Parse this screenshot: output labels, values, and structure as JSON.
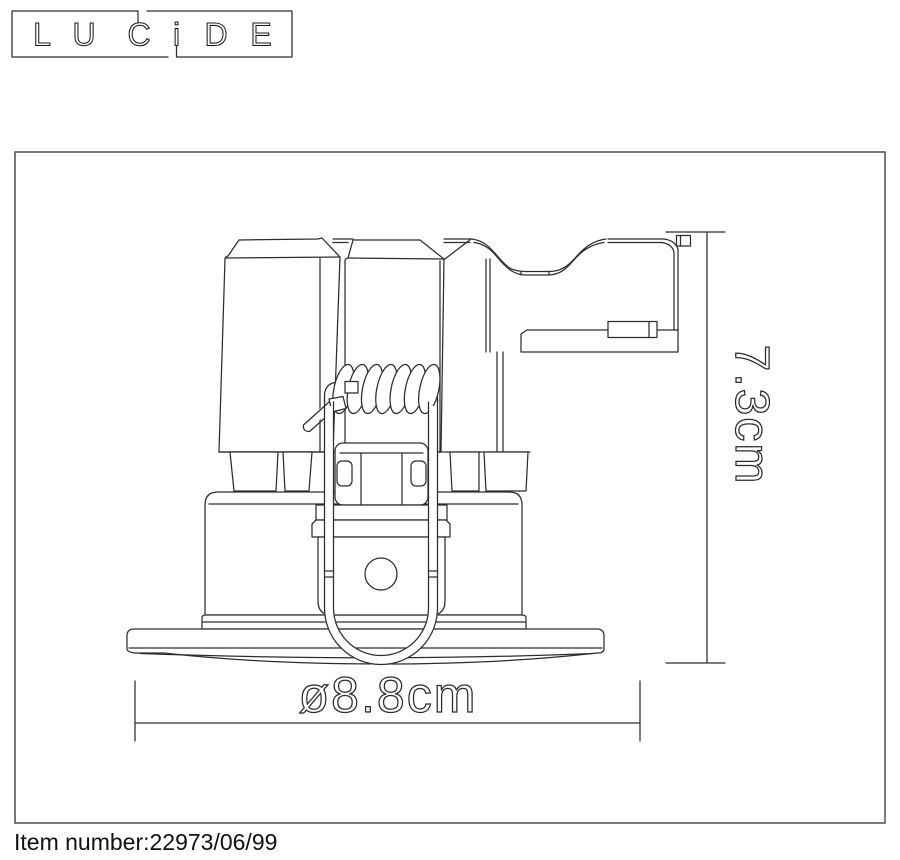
{
  "logo": {
    "word": "LUCIDE",
    "letters": [
      "L",
      "U",
      "C",
      "i",
      "D",
      "E"
    ]
  },
  "drawing": {
    "type": "technical-line-drawing",
    "subject": "recessed ceiling spotlight, side elevation with spring mounting clip",
    "dimensions": {
      "height": "7.3cm",
      "diameter": "ø8.8cm"
    }
  },
  "footer": {
    "item_number": "Item number:22973/06/99"
  },
  "colors": {
    "line": "#2d2d2d",
    "frame": "#4d4d4d",
    "text": "#1a1a1a",
    "background": "#ffffff"
  }
}
